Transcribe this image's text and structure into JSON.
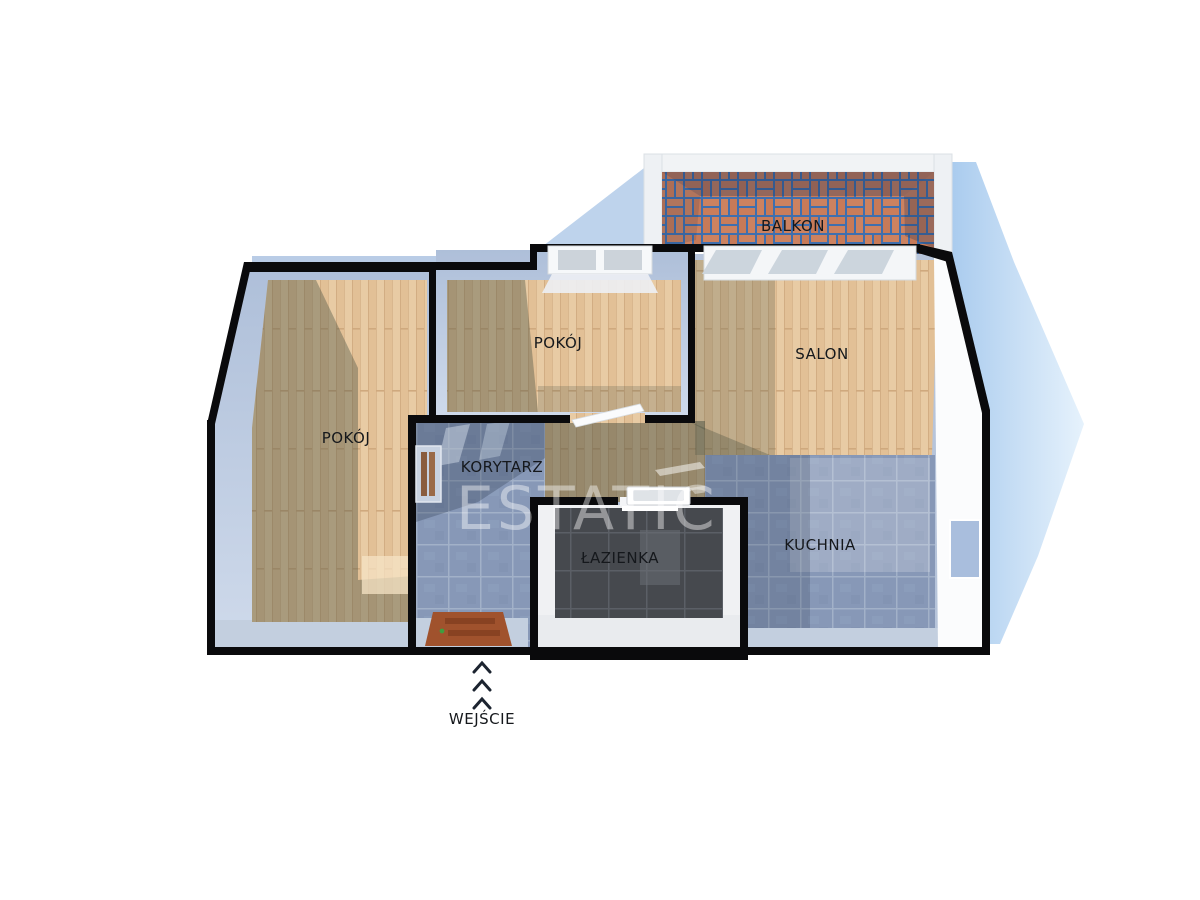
{
  "watermark": {
    "text": "ESTATIC"
  },
  "rooms": {
    "balkon": {
      "label": "BALKON"
    },
    "pokoj_top": {
      "label": "POKÓJ"
    },
    "pokoj_left": {
      "label": "POKÓJ"
    },
    "salon": {
      "label": "SALON"
    },
    "korytarz": {
      "label": "KORYTARZ"
    },
    "lazienka": {
      "label": "ŁAZIENKA"
    },
    "kuchnia": {
      "label": "KUCHNIA"
    }
  },
  "entrance": {
    "label": "WEJŚCIE",
    "arrow_count": 3
  },
  "colors": {
    "wall": "#0a0a0c",
    "wood_floor": "#e8cba4",
    "tile_floor": "#8798b7",
    "bath_tile": "#46494e",
    "brick": "#c97d5b",
    "brick_grout": "#3f6fae",
    "drop_shadow": "#b4d2f0",
    "wall_face": "#b6c4da"
  }
}
